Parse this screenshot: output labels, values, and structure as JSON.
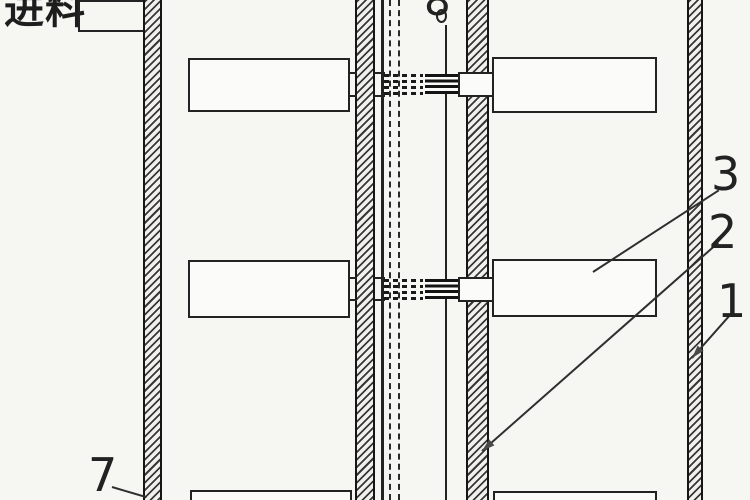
{
  "figure": {
    "labels": {
      "feed": "进料",
      "part8": "8",
      "part3": "3",
      "part2": "2",
      "part1": "1",
      "part7": "7"
    },
    "colors": {
      "background": "#f6f6f3",
      "line": "#232323"
    }
  }
}
